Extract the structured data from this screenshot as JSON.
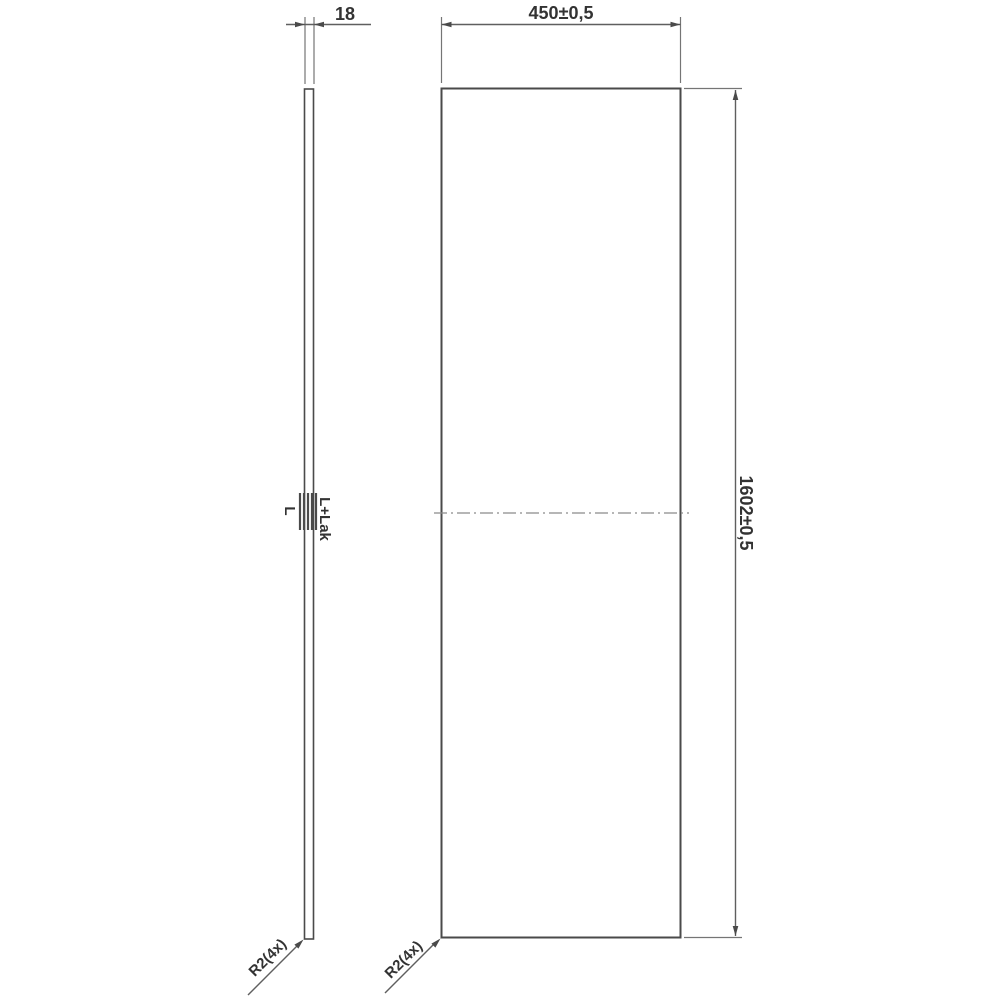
{
  "drawing": {
    "description": "Technical drawing of a rectangular panel: thin side view (left) and front view (right) with dimensions and surface-finish annotations",
    "colors": {
      "background": "#ffffff",
      "outline": "#4a4a4a",
      "dimension_line": "#5f5f5f",
      "extension_line": "#757575",
      "centerline": "#8a8a8a",
      "text": "#333333"
    },
    "dimensions": {
      "thickness": "18",
      "width": "450±0,5",
      "height": "1602±0,5"
    },
    "annotations": {
      "surface_left": "L",
      "surface_right": "L+Lak",
      "corner_radius_side_view": "R2(4x)",
      "corner_radius_front_view": "R2(4x)"
    }
  }
}
